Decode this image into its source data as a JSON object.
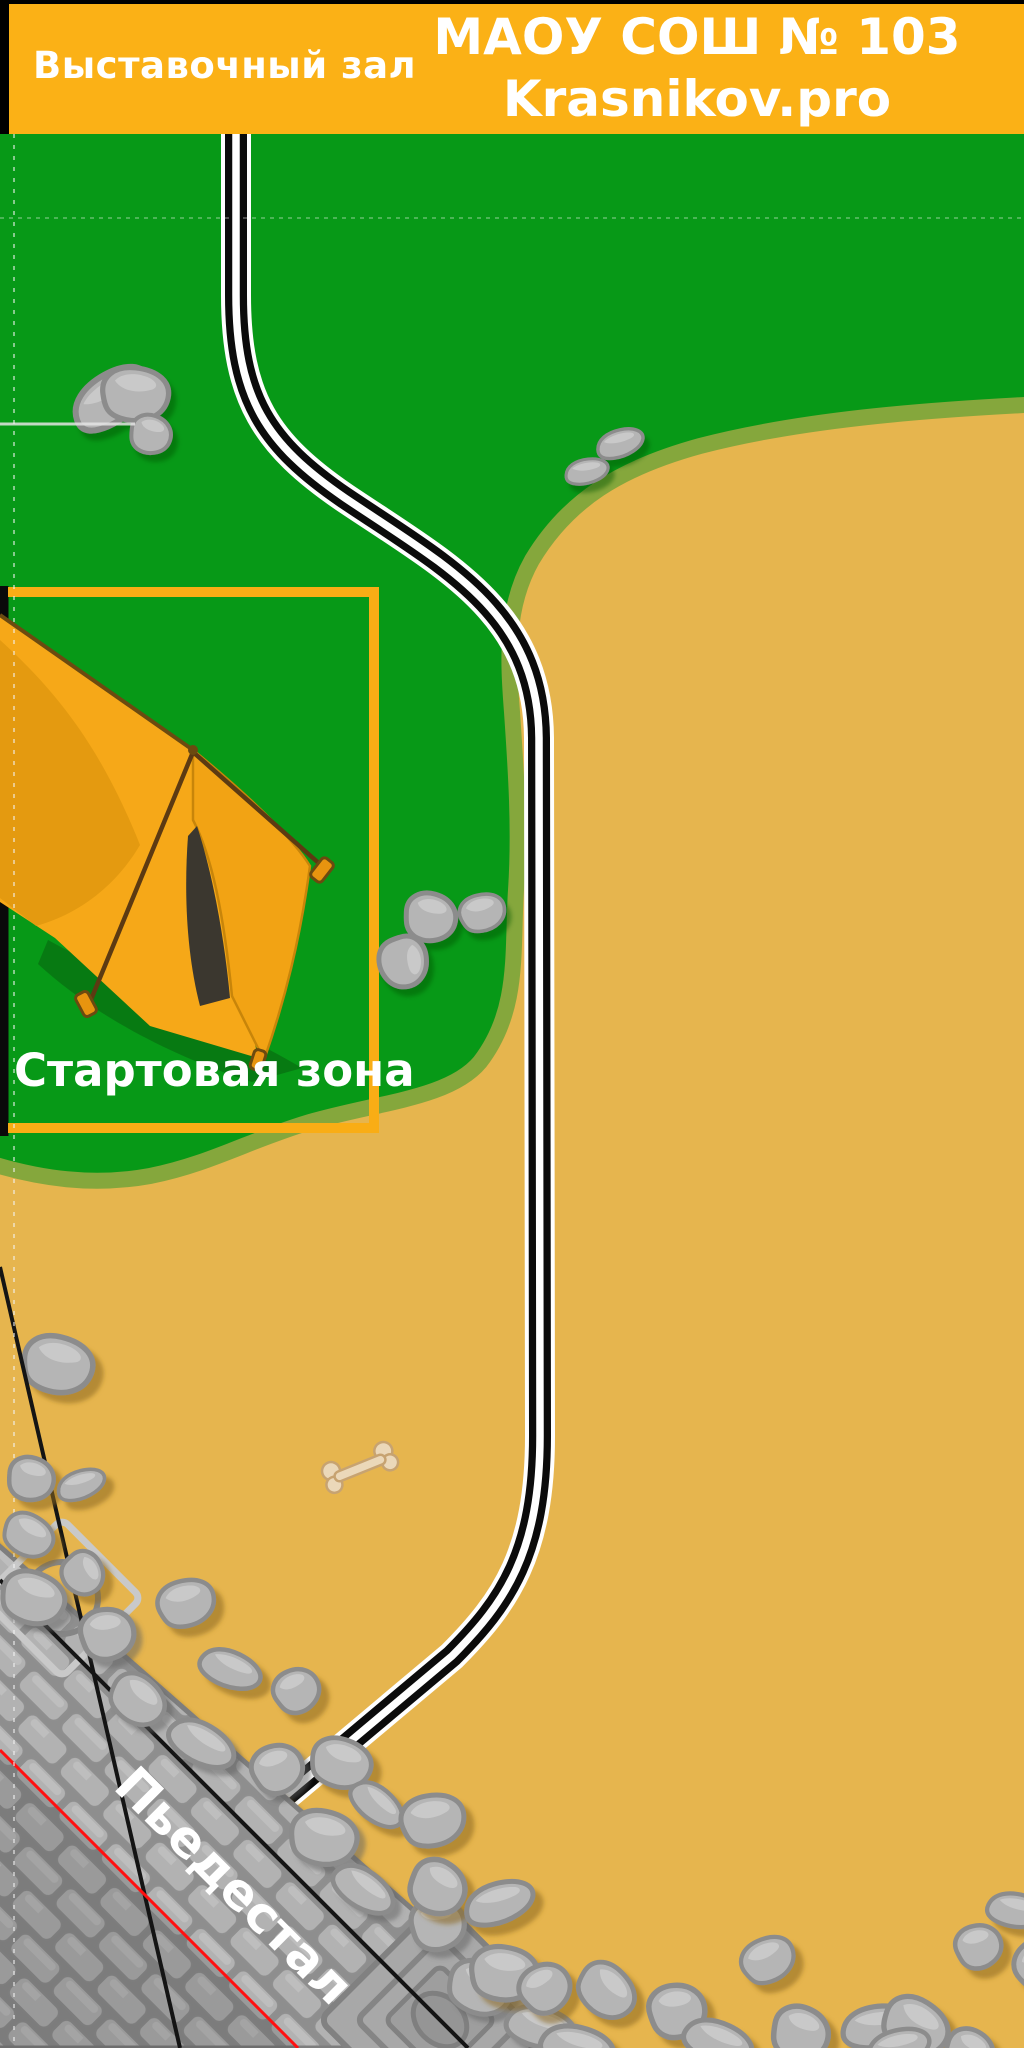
{
  "header": {
    "left_title": "Выставочный зал",
    "right_line1": "МАОУ СОШ № 103",
    "right_line2": "Krasnikov.pro"
  },
  "map": {
    "start_zone_label": "Стартовая зона",
    "pedestal_label": "Пьедестал"
  },
  "colors": {
    "header_bg": "#FBB116",
    "grass": "#079917",
    "grass_edge": "#85A73C",
    "sand": "#E6B54E",
    "zone_border": "#F9AD15",
    "road_black": "#0B0B0B",
    "line_black": "#141414",
    "line_red": "#FF1010",
    "stone_fill": "#B5B5B5",
    "stone_edge": "#8C8C8C",
    "brick_fill": "#B2B2B2",
    "mortar": "#8E8E8E",
    "tent_main": "#F6A818",
    "tent_dark": "#DD960E",
    "tent_interior": "#3B372F",
    "rope_brown": "#5C3A12",
    "bone_fill": "#EBD8B9",
    "bone_edge": "#C7A371",
    "text_white": "#FFFFFF"
  }
}
